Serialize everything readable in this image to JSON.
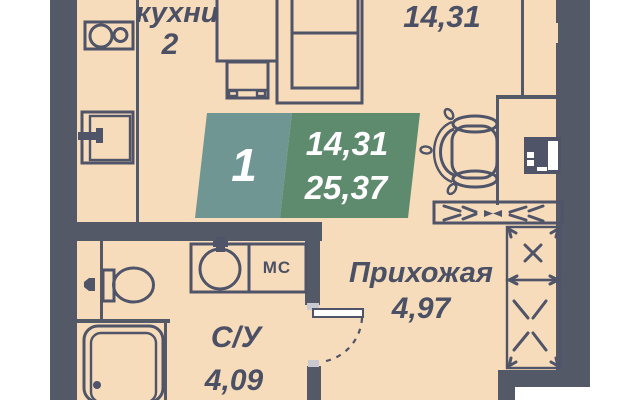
{
  "plan": {
    "badge": {
      "unit_number": "1",
      "living_area": "14,31",
      "total_area": "25,37"
    },
    "rooms": {
      "kitchen": {
        "label": "кухни",
        "number": "2"
      },
      "living": {
        "area": "14,31"
      },
      "hallway": {
        "label": "Прихожая",
        "area": "4,97"
      },
      "bathroom": {
        "label": "С/У",
        "area": "4,09"
      }
    },
    "appliances": {
      "washing_machine_label": "МС"
    },
    "fixtures": [
      "cooktop-icon",
      "kitchen-sink-icon",
      "wardrobe-icon",
      "nightstand-icon",
      "bed-icon",
      "dining-table-icon",
      "tv-unit-icon",
      "console-shelf-icon",
      "closet-icon",
      "door-swing-icon",
      "toilet-icon",
      "washbasin-icon",
      "shower-icon",
      "water-valve-icon"
    ],
    "colors": {
      "floor": "#f6dcba",
      "wall": "#545968",
      "line": "#4f5468",
      "badge_teal": "#709693",
      "badge_green": "#5e8a6e",
      "text": "#4b5065",
      "door_leaf": "#ffffff"
    }
  }
}
